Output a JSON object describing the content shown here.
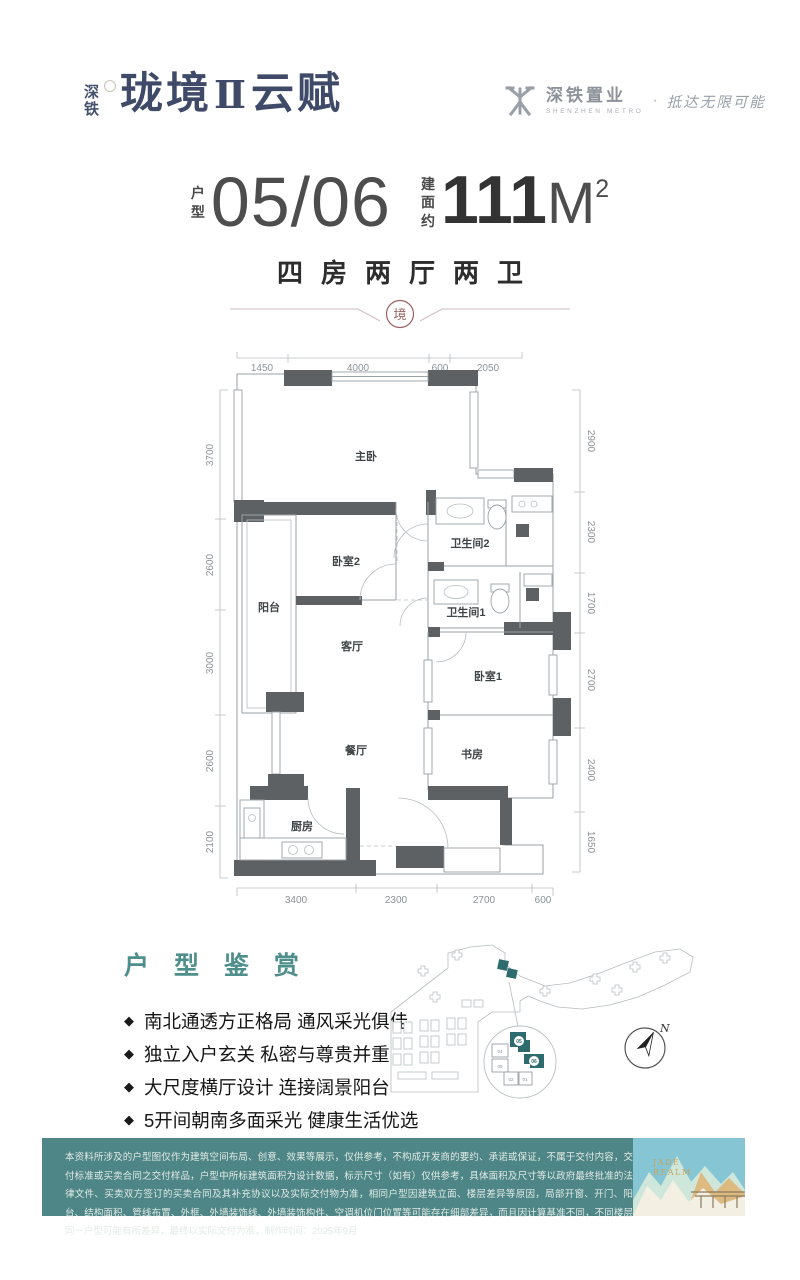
{
  "header": {
    "logo": {
      "prefix_top": "深",
      "prefix_bottom": "铁",
      "main": "珑境",
      "roman": "Ⅱ",
      "suffix": "云赋"
    },
    "developer": {
      "name": "深铁置业",
      "name_en": "SHENZHEN METRO",
      "dot": "·",
      "slogan": "抵达无限可能"
    }
  },
  "title": {
    "unit_label_1": "户",
    "unit_label_2": "型",
    "unit_value": "05/06",
    "area_label_1": "建",
    "area_label_2": "面",
    "area_label_3": "约",
    "area_value": "111",
    "area_unit": "M",
    "area_sup": "2",
    "layout_text": "四房两厅两卫",
    "seal_char": "境"
  },
  "floorplan": {
    "dims_top": [
      "1450",
      "4000",
      "600",
      "2050"
    ],
    "dims_left": [
      "3700",
      "2600",
      "3000",
      "2600",
      "2100"
    ],
    "dims_right": [
      "2900",
      "2300",
      "1700",
      "2700",
      "2400",
      "1650"
    ],
    "dims_bottom": [
      "3400",
      "2300",
      "2700",
      "600"
    ],
    "rooms": {
      "master": "主卧",
      "bed2": "卧室2",
      "bath2": "卫生间2",
      "bath1": "卫生间1",
      "balcony": "阳台",
      "living": "客厅",
      "dining": "餐厅",
      "bed1": "卧室1",
      "study": "书房",
      "kitchen": "厨房"
    }
  },
  "features": {
    "heading": "户 型 鉴 赏",
    "marker": "◆",
    "items": [
      "南北通透方正格局  通风采光俱佳",
      "独立入户玄关  私密与尊贵并重",
      "大尺度横厅设计  连接阔景阳台",
      "5开间朝南多面采光  健康生活优选"
    ]
  },
  "sitemap": {
    "compass": "N",
    "tower05": "05",
    "tower06": "06",
    "unit04": "04",
    "unit05": "05",
    "unit02": "02",
    "unit01": "01"
  },
  "footer": {
    "disclaimer": "本资料所涉及的户型图仅作为建筑空间布局、创意、效果等展示，仅供参考，不构成开发商的要约、承诺或保证，不属于交付内容，交付标准或买卖合同之交付样品，户型中所标建筑面积为设计数据，标示尺寸（如有）仅供参考，具体面积及尺寸等以政府最终批准的法律文件、买卖双方签订的买卖合同及其补充协议以及实际交付物为准，相同户型因建筑立面、楼层差异等原因，局部开窗、开门、阳台、结构面积、管线布置、外框、外墙装饰线、外墙装饰构件、空调机位门位置等可能存在细部差异，而且因计算基准不同，不同楼层同一户型可能有所差异，最终以实际交付为准，制作时间：2025年9月",
    "art_line1": "JADE",
    "art_line2": "REALM"
  },
  "colors": {
    "teal": "#4E8586",
    "navy": "#3E4A68",
    "seal_red": "#9D6161",
    "wall_gray": "#5D6164",
    "accent_teal": "#2E6B6E"
  }
}
